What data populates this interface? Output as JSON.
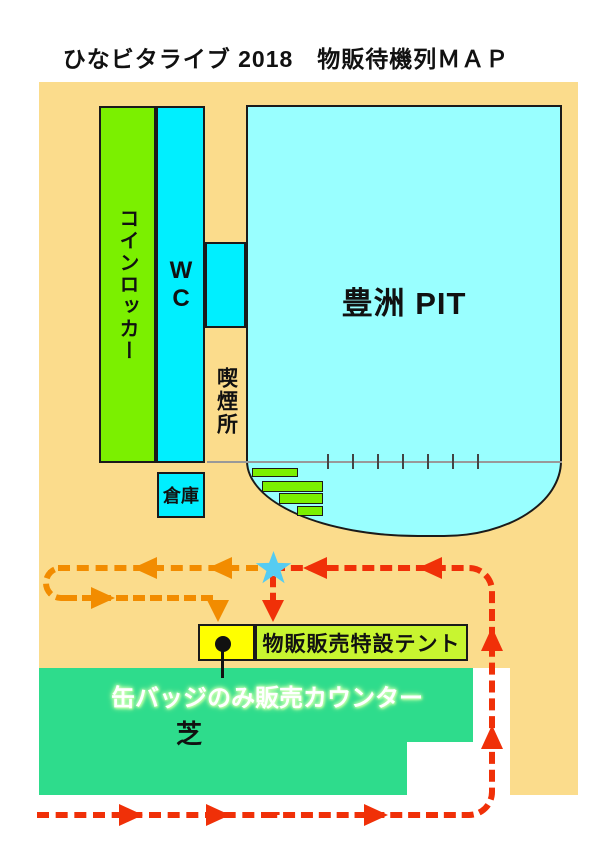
{
  "title": "ひなビタライブ 2018　物販待機列ＭＡＰ",
  "venue": {
    "name": "豊洲 PIT"
  },
  "buildings": {
    "coin_locker": "コインロッカー",
    "toilet": "WC",
    "smoking_area": "喫煙所",
    "warehouse": "倉庫"
  },
  "sales": {
    "tent": "物販販売特設テント",
    "badge_counter": "缶バッジのみ販売カウンター",
    "lawn": "芝"
  },
  "colors": {
    "map_bg": "#FBDC8C",
    "building_green": "#7BF000",
    "building_cyan": "#00EFFF",
    "venue_fill": "#99FFFF",
    "lawn_green": "#2EDC8C",
    "tent_fill": "#C8F530",
    "badge_box_fill": "#FFFF00",
    "star_fill": "#55CCF2",
    "merch_queue_color": "#F03008",
    "badge_queue_color": "#F28C00"
  }
}
